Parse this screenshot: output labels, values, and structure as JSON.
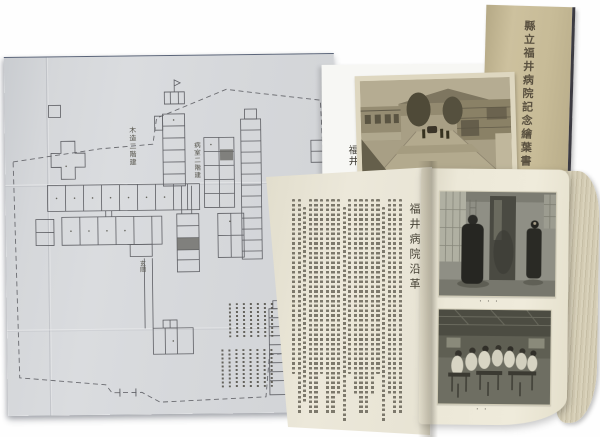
{
  "scene": {
    "description": "Photograph of Fukui prefectural hospital commemorative materials: folded floor plan, open history booklet with photographs, sepia street-view postcard, and tan cover card"
  },
  "cover_card": {
    "title_vertical": "縣立福井病院記念繪葉書"
  },
  "background_sheet": {
    "visible_title": "福井"
  },
  "floor_plan": {
    "label_upper_block": "木造二階建",
    "label_ward_block": "病室二階建",
    "label_entrance": "玄關",
    "legend": {
      "group1_columns": 7,
      "group2_columns": 8
    }
  },
  "booklet": {
    "left_page": {
      "section_title": "福井病院沿革",
      "body_columns": 20
    },
    "right_page": {
      "photo_top_caption": "・・・",
      "photo_bottom_caption": "・・"
    }
  },
  "colors": {
    "plan_paper": "#d7d9db",
    "booklet_paper": "#eae6d6",
    "cover_card_paper": "#c8bc98",
    "postcard_sepia": "#a99f85",
    "photo_gray": "#8f8f85",
    "background": "#ffffff"
  }
}
